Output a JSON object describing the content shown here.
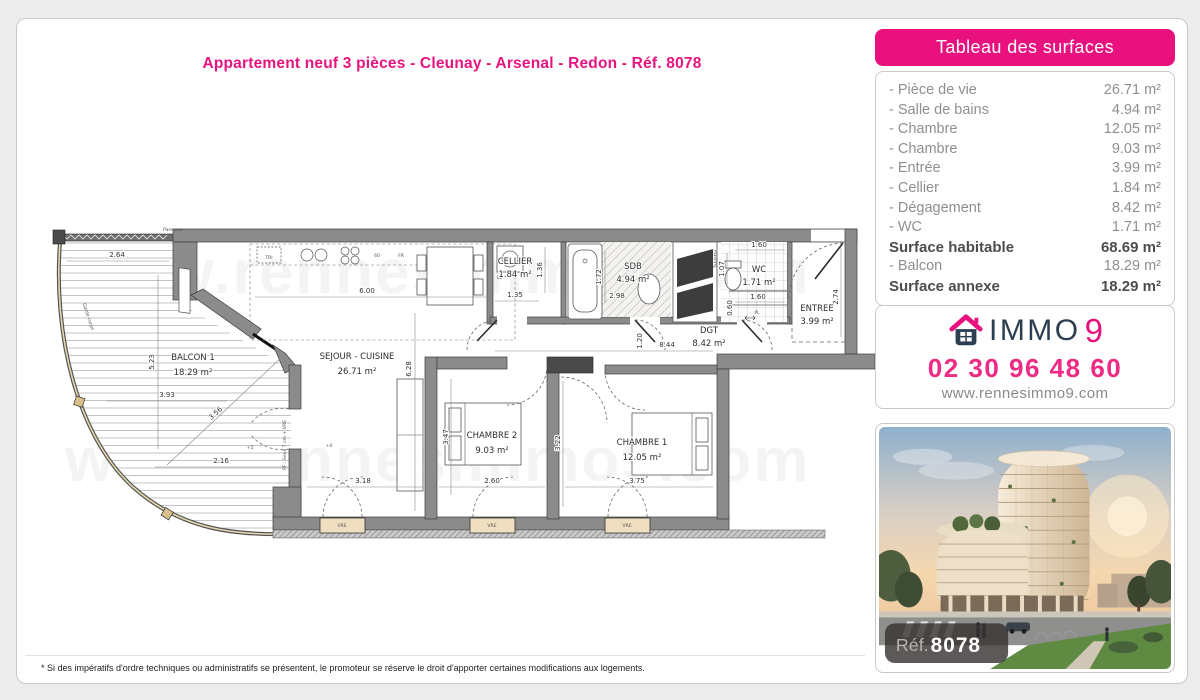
{
  "page": {
    "title": "Appartement neuf 3 pièces - Cleunay - Arsenal - Redon - Réf. 8078",
    "footnote": "* Si des impératifs d'ordre techniques ou administratifs se présentent, le promoteur se réserve le droit d'apporter certaines modifications aux logements.",
    "brand_pink": "#e8117d"
  },
  "surfaces_panel": {
    "header": "Tableau des surfaces",
    "rows": [
      {
        "label": "- Pièce de vie",
        "value": "26.71 m²"
      },
      {
        "label": "- Salle de bains",
        "value": "4.94 m²"
      },
      {
        "label": "- Chambre",
        "value": "12.05 m²"
      },
      {
        "label": "- Chambre",
        "value": "9.03 m²"
      },
      {
        "label": "- Entrée",
        "value": "3.99 m²"
      },
      {
        "label": "- Cellier",
        "value": "1.84 m²"
      },
      {
        "label": "- Dégagement",
        "value": "8.42 m²"
      },
      {
        "label": "- WC",
        "value": "1.71 m²"
      },
      {
        "label": "Surface habitable",
        "value": "68.69 m²"
      },
      {
        "label": "- Balcon",
        "value": "18.29 m²"
      },
      {
        "label": "Surface annexe",
        "value": "18.29 m²"
      }
    ]
  },
  "contact": {
    "brand_immo": "IMMO",
    "brand_nine": "9",
    "phone": "02 30 96 48 60",
    "website": "www.rennesimmo9.com"
  },
  "photo": {
    "ref_label": "Réf.",
    "ref_number": "8078"
  },
  "floorplan": {
    "watermark": "www.rennesimmo9.com",
    "rooms": [
      {
        "name": "BALCON 1",
        "area": "18.29 m²"
      },
      {
        "name": "SEJOUR - CUISINE",
        "area": "26.71 m²"
      },
      {
        "name": "CELLIER",
        "area": "1.84 m²"
      },
      {
        "name": "SDB",
        "area": "4.94 m²"
      },
      {
        "name": "WC",
        "area": "1.71 m²"
      },
      {
        "name": "ENTREE",
        "area": "3.99 m²"
      },
      {
        "name": "DGT",
        "area": "8.42 m²"
      },
      {
        "name": "CHAMBRE 2",
        "area": "9.03 m²"
      },
      {
        "name": "CHAMBRE 1",
        "area": "12.05 m²"
      }
    ],
    "dims": [
      "2.64",
      "5.23",
      "3.93",
      "3.56",
      "2.16",
      "6.00",
      "6.28",
      "3.18",
      "3.47",
      "2.60",
      "3.22",
      "3.75",
      "8.44",
      "1.20",
      "1.35",
      "1.36",
      "1.72",
      "2.98",
      "1.60",
      "1.07",
      "1.60",
      "0.60",
      "2.74"
    ],
    "annotations": {
      "pare_vue": "Pare vue",
      "garde_corps": "Garde corps",
      "tri": "TRI",
      "d60": "60",
      "fr": "FR",
      "ll": "LL",
      "pl": "PL",
      "tablette": "Tablette",
      "plus5": "+5",
      "plus0": "+0",
      "seuil": "PF : Seuil 7 cm + VRE",
      "vre": "VRE"
    }
  }
}
